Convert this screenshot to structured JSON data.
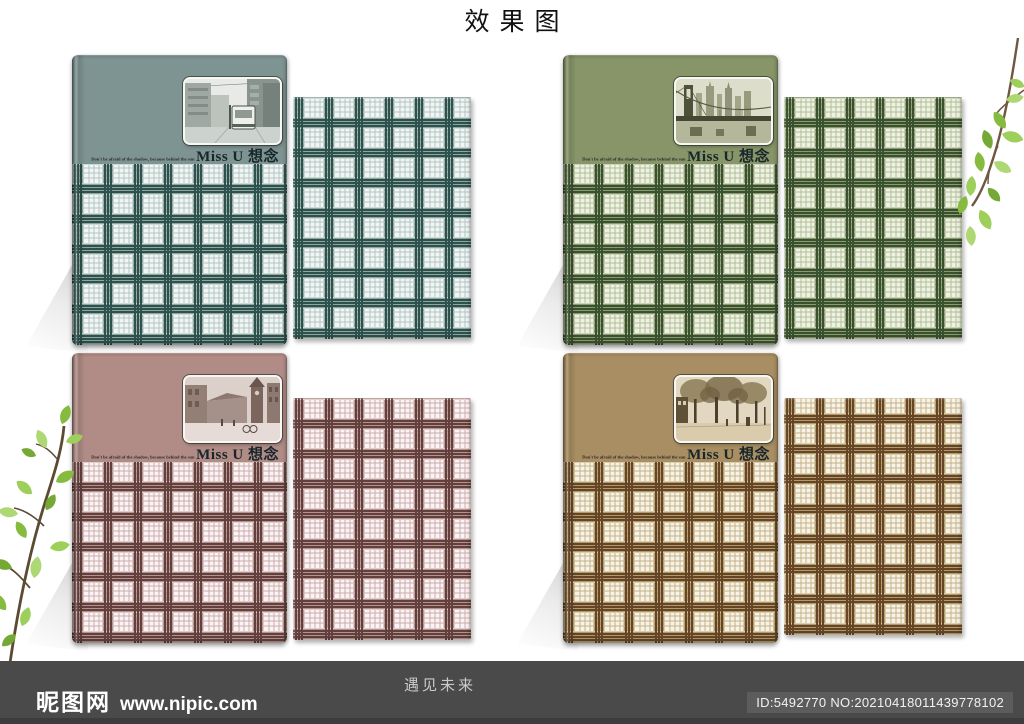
{
  "page": {
    "title": "效果图"
  },
  "notebooks": [
    {
      "id": "teal",
      "photo": "photo-cable-car-street",
      "caption_small": "Don't be afraid of the shadow, because behind the sun",
      "caption_main": "Miss U 想念",
      "colors": {
        "cover": "#7e9492",
        "band": "#90a4a0",
        "dark": "#2d514c",
        "pale": "#cdd9d6",
        "line": "#b4c5c1",
        "white": "#f1f6f5"
      }
    },
    {
      "id": "green",
      "photo": "photo-bridge-skyline",
      "caption_small": "Don't be afraid of the shadow, because behind the sun",
      "caption_main": "Miss U 想念",
      "colors": {
        "cover": "#879569",
        "band": "#8b9970",
        "dark": "#3a512f",
        "pale": "#ccd2b8",
        "line": "#b3bd9a",
        "white": "#eef2e2"
      }
    },
    {
      "id": "pink",
      "photo": "photo-town-square",
      "caption_small": "Don't be afraid of the shadow, because behind the sun",
      "caption_main": "Miss U 想念",
      "colors": {
        "cover": "#b18c86",
        "band": "#b2938e",
        "dark": "#63403d",
        "pale": "#e0cdca",
        "line": "#cbaeaa",
        "white": "#fbf3f5"
      }
    },
    {
      "id": "brown",
      "photo": "photo-tree-street",
      "caption_small": "Don't be afraid of the shadow, because behind the sun",
      "caption_main": "Miss U 想念",
      "colors": {
        "cover": "#a88e62",
        "band": "#b09a6c",
        "dark": "#654526",
        "pale": "#d9cdaa",
        "line": "#c4b288",
        "white": "#f8f3e7"
      }
    }
  ],
  "footer": {
    "logo": "昵图网",
    "site": "www.nipic.com",
    "slogan": "遇见未来",
    "id_text": "ID:5492770 NO:20210418011439778102",
    "colors": {
      "bar": "#4a4a4a",
      "badge": "#5c5c5c"
    }
  }
}
